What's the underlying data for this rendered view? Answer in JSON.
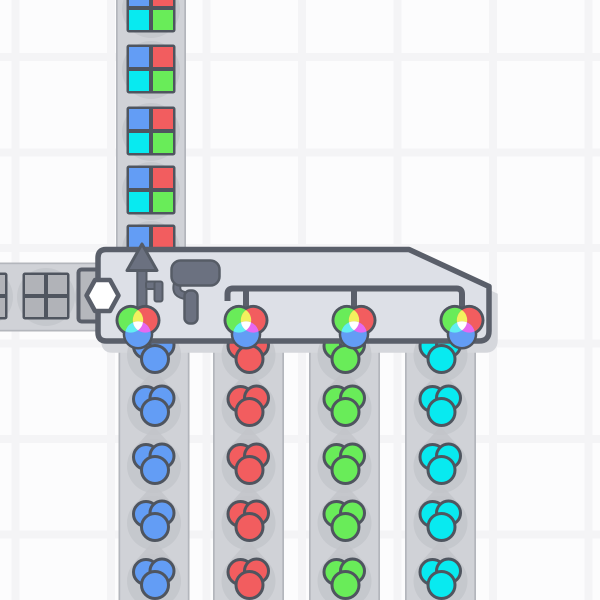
{
  "viewport": {
    "width": 600,
    "height": 600,
    "background": "#fcfcfd"
  },
  "palette": {
    "background": "#fcfcfd",
    "grid_line": "#f4f4f6",
    "belt_fill": "#d0d2d7",
    "belt_edge": "#b3b6bc",
    "belt_arrow": "#c5c7cc",
    "item_shadow": "#c2c4c9",
    "machine_fill": "#dde0e7",
    "machine_border": "#5a5f6a",
    "machine_shadow": "#d5d7dc",
    "socket_fill": "#b5b7bc",
    "icon_fill": "#6b7180",
    "icon_border": "#565c66",
    "item_border": "#4f555f",
    "uncolored": "#b1b3b8",
    "red": "#f25d5f",
    "green": "#69ec59",
    "blue": "#639df5",
    "cyan": "#08eaf0",
    "yellow": "#f3f15e",
    "cyan_lens": "#62eef2",
    "magenta": "#e768f0",
    "white": "#ffffff",
    "hexagon_fill": "#ffffff"
  },
  "grid": {
    "line_width": 8,
    "vertical_x": [
      15.5,
      111,
      206.5,
      302,
      397.5,
      493,
      588.5
    ],
    "horizontal_y": [
      57,
      152.5,
      248,
      343.5,
      439,
      534.5
    ]
  },
  "machine": {
    "name": "quad-painter",
    "body_path": "M106,249.5 H409 L489,286.5 V331 Q489,341 479,341 H106.5 Q98,341 98,332.5 V258 Q98,249.5 106,249.5 Z",
    "shadow_offset": {
      "dx": 6,
      "dy": 9
    },
    "socket": {
      "x": 78.5,
      "y": 269.5,
      "w": 27,
      "h": 52
    },
    "hexagon_points": "86.5,295.5 95,280 110,280 118.5,295.5 110,311 95,311",
    "output_arrow": {
      "head_points": "142,244 157,270.5 127,270.5",
      "shaft": {
        "x": 137.3,
        "y": 266,
        "w": 9.2,
        "h": 57
      },
      "branch": {
        "x": 146,
        "y": 281.5,
        "w": 15,
        "h": 7.5
      },
      "stub": {
        "x": 154.5,
        "y": 281.5,
        "w": 8,
        "h": 20
      }
    },
    "paint_roller": {
      "arm_path": "M178,282 C174.5,292 179,295 188,296",
      "head": {
        "x": 171.5,
        "y": 260.5,
        "w": 48,
        "h": 25,
        "r": 9
      },
      "handle": {
        "x": 184.5,
        "y": 290.5,
        "w": 13,
        "h": 33,
        "r": 5.5
      }
    },
    "pipe_paths": [
      "M227.5,301 V294 Q227.5,288.5 233,288.5 H456.5 Q462,288.5 462,294 V309",
      "M246,291.5 V309",
      "M354,291.5 V309"
    ],
    "paint_input_icons": {
      "centers": [
        [
          138,
          327
        ],
        [
          246,
          327
        ],
        [
          354,
          327
        ],
        [
          462,
          327
        ]
      ],
      "accepted": "any-color",
      "offsets": {
        "green": [
          -7.2,
          -6.8
        ],
        "red": [
          7.2,
          -6.8
        ],
        "blue": [
          0,
          7.2
        ]
      },
      "r_color": 12.4,
      "r_blue": 12.8,
      "r_outline": 15.3
    }
  },
  "belts": {
    "top_output": {
      "direction": "up",
      "x": 116,
      "width": 70,
      "y0": 0,
      "y1": 252,
      "item_center_x": 151,
      "item_centers_y": [
        8,
        69,
        131,
        190,
        249
      ],
      "item_size": 49,
      "item_quadrant_colors": [
        "blue",
        "red",
        "cyan",
        "green"
      ],
      "item_kind": "painted-square-shape"
    },
    "left_input": {
      "direction": "right",
      "y": 262.5,
      "height": 69,
      "x0": 0,
      "x1": 101,
      "item_center_y": 296,
      "item_centers_x": [
        -16,
        46,
        104
      ],
      "item_size": 47,
      "item_quadrant_colors": [
        "uncolored",
        "uncolored",
        "uncolored",
        "uncolored"
      ],
      "item_kind": "uncolored-square-shape"
    },
    "paint_inputs": [
      {
        "direction": "up",
        "x": 118.5,
        "width": 71,
        "y0": 341,
        "color": "blue",
        "item_centers_y": [
          353,
          406,
          464,
          521,
          579
        ],
        "arrow_centers_y": [
          380,
          437,
          494,
          551
        ]
      },
      {
        "direction": "up",
        "x": 213,
        "width": 71,
        "y0": 341,
        "color": "red",
        "item_centers_y": [
          353,
          406,
          464,
          521,
          579
        ],
        "arrow_centers_y": [
          380,
          437,
          494,
          551
        ]
      },
      {
        "direction": "up",
        "x": 309,
        "width": 71,
        "y0": 341,
        "color": "green",
        "item_centers_y": [
          353,
          406,
          464,
          521,
          579
        ],
        "arrow_centers_y": [
          380,
          437,
          494,
          551
        ]
      },
      {
        "direction": "up",
        "x": 405,
        "width": 71,
        "y0": 341,
        "color": "cyan",
        "item_centers_y": [
          353,
          406,
          464,
          521,
          579
        ],
        "arrow_centers_y": [
          380,
          437,
          494,
          551
        ]
      }
    ],
    "blob_geometry": {
      "circles": [
        [
          -8,
          -7,
          12.5
        ],
        [
          8,
          -8,
          12
        ],
        [
          1,
          6,
          13.5
        ]
      ],
      "shadow_r": 27
    },
    "square_shadow_r": 29
  }
}
